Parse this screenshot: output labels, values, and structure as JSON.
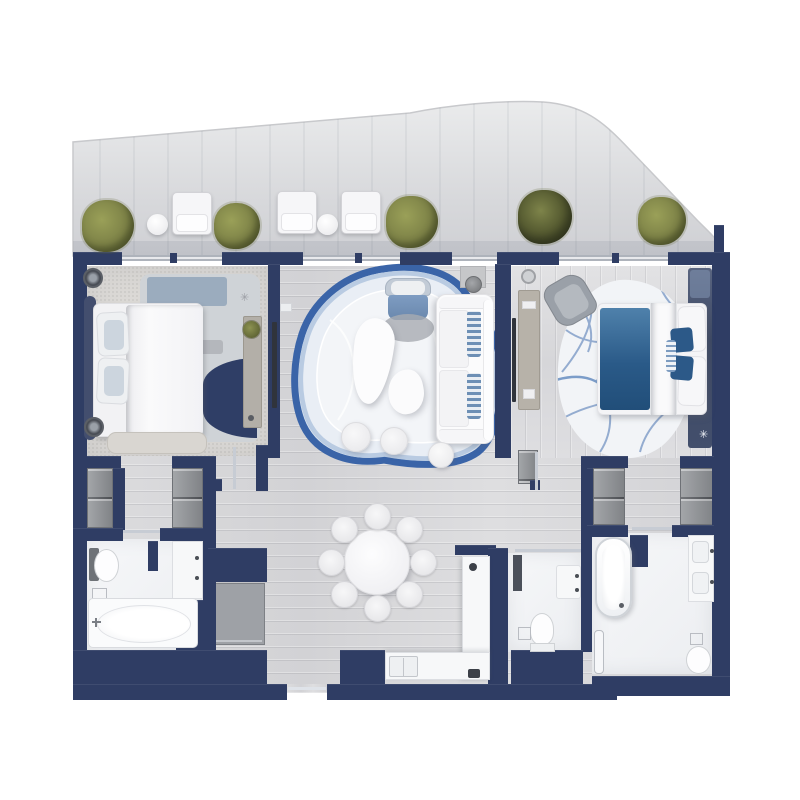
{
  "scene": {
    "type": "floor-plan",
    "description": "two-bedroom apartment plan, top-down render, no text labels"
  },
  "palette": {
    "wall": "#2f3d64",
    "floor_wood": "#d7d7d9",
    "carpet": "#dbd9d6",
    "bath_floor": "#f2f3f5",
    "closet_gray": "#8f9296",
    "terrace": "#d9dadc",
    "rug_outer_blue": "#3a64a8",
    "rug_inner_blue": "#b9cbe2",
    "rug_pale": "#edf1f7",
    "accent_blue": "#2c5a88",
    "swirl_blue": "#8aa5cb",
    "plant_green": "#7d8247",
    "plant_green_dark": "#5f6434",
    "white_furniture": "#f5f5f7"
  },
  "rooms": [
    {
      "name": "terrace"
    },
    {
      "name": "bedroom-1"
    },
    {
      "name": "living-dining"
    },
    {
      "name": "bedroom-2"
    },
    {
      "name": "bathroom-1"
    },
    {
      "name": "wc"
    },
    {
      "name": "master-bathroom"
    },
    {
      "name": "kitchen"
    },
    {
      "name": "walk-in-closets"
    }
  ],
  "terrace": {
    "plants": [
      {
        "x": 108,
        "y": 226,
        "r": 26
      },
      {
        "x": 237,
        "y": 226,
        "r": 23
      },
      {
        "x": 412,
        "y": 222,
        "r": 26
      },
      {
        "x": 545,
        "y": 217,
        "r": 27,
        "dark": true
      },
      {
        "x": 662,
        "y": 221,
        "r": 24
      }
    ],
    "chairs": [
      {
        "x": 172,
        "y": 192
      },
      {
        "x": 277,
        "y": 191
      },
      {
        "x": 341,
        "y": 191
      }
    ],
    "side_tables": [
      {
        "x": 147,
        "y": 214
      },
      {
        "x": 317,
        "y": 214
      }
    ]
  },
  "dining": {
    "table": {
      "cx": 377,
      "cy": 562,
      "r": 33
    },
    "chairs": {
      "count": 8,
      "ring_radius": 46,
      "diameter": 27
    }
  },
  "sparkles": [
    {
      "x": 240,
      "y": 293,
      "color": "#9a9da3"
    },
    {
      "x": 699,
      "y": 430,
      "color": "#eef1f6"
    }
  ]
}
